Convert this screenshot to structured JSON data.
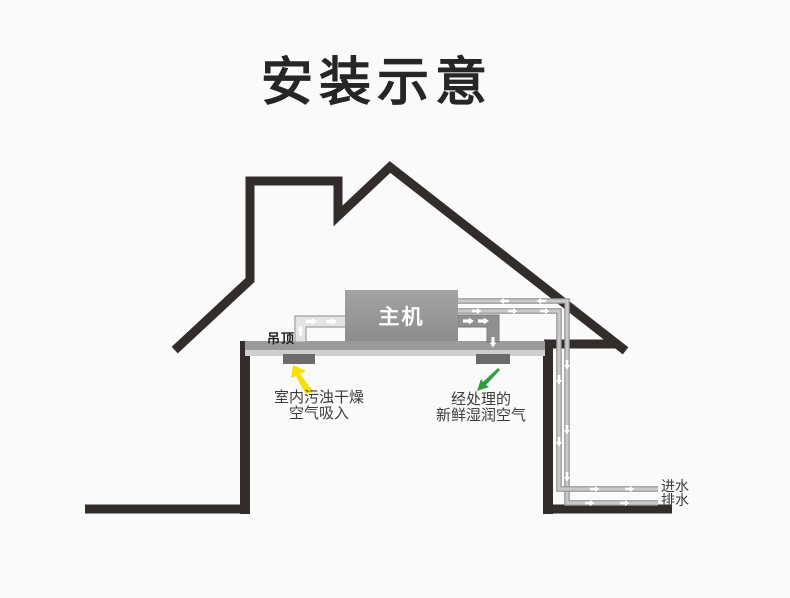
{
  "title": "安装示意",
  "diagram": {
    "unit_label": "主机",
    "ceiling_label": "吊顶",
    "inlet_label": "进水",
    "drain_label": "排水",
    "intake_annotation": {
      "line1": "室内污浊干燥",
      "line2": "空气吸入"
    },
    "supply_annotation": {
      "line1": "经处理的",
      "line2": "新鲜湿润空气"
    },
    "icons": {
      "intake_arrow": "yellow-bent-arrow-up-left",
      "supply_arrow": "green-arrow-down-left"
    },
    "colors": {
      "background": "#fafafa",
      "house_outline": "#322c2a",
      "main_unit": "#949496",
      "ceiling_dark": "#9a9a9a",
      "ceiling_light": "#cfcfcf",
      "vent": "#6b6b6b",
      "return_duct": "#e4e4e4",
      "supply_duct": "#909092",
      "pipe": "#c9c9c9",
      "intake_arrow": "#f7df00",
      "supply_arrow": "#2f9e41",
      "title_text": "#262626"
    }
  }
}
